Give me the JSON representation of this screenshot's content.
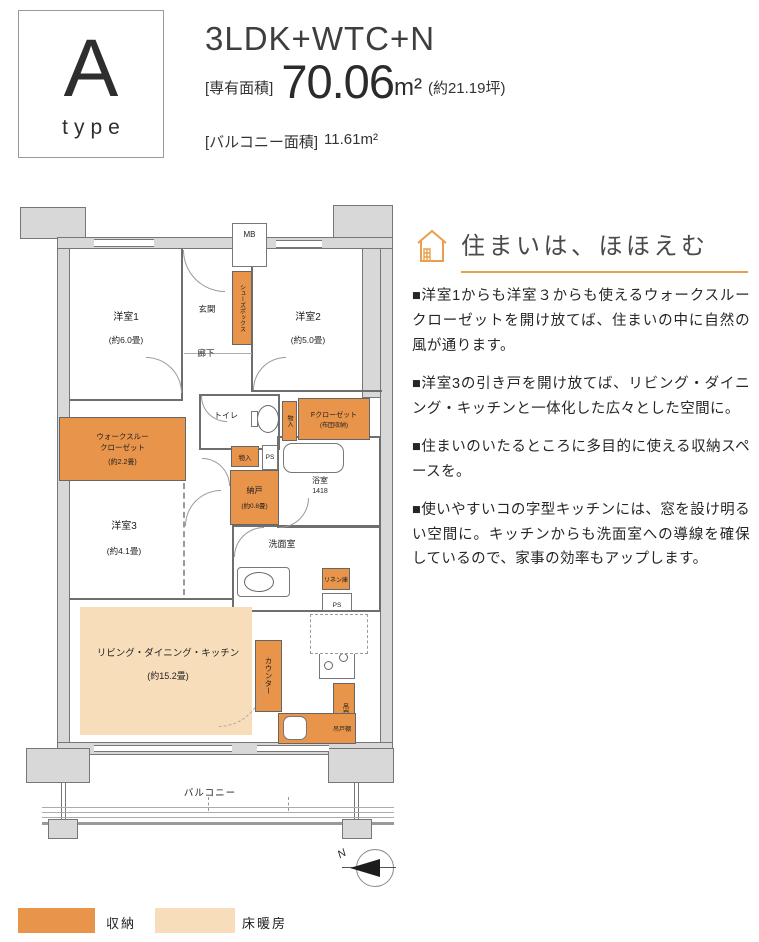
{
  "colors": {
    "accent_orange": "#E8A04E",
    "storage_orange": "#E8954B",
    "floor_heating_peach": "#F8DDBB",
    "wall_gray": "#D8D8D8"
  },
  "header": {
    "type_letter": "A",
    "type_word": "type",
    "plan_name": "3LDK+WTC+N",
    "area_label": "[専有面積]",
    "area_value": "70.06",
    "area_unit": "m²",
    "area_tsubo": "(約21.19坪)",
    "balcony_label": "[バルコニー面積]",
    "balcony_value": "11.61m²"
  },
  "feature": {
    "heading": "住まいは、ほほえむ",
    "paragraphs": [
      "■洋室1からも洋室３からも使えるウォークスルークローゼットを開け放てば、住まいの中に自然の風が通ります。",
      "■洋室3の引き戸を開け放てば、リビング・ダイニング・キッチンと一体化した広々とした空間に。",
      "■住まいのいたるところに多目的に使える収納スペースを。",
      "■使いやすいコの字型キッチンには、窓を設け明るい空間に。キッチンからも洗面室への導線を確保しているので、家事の効率もアップします。"
    ]
  },
  "plan": {
    "mb": "MB",
    "genkan": "玄関",
    "shoes_box": "シューズボックス",
    "rouka": "廊下",
    "room1_name": "洋室1",
    "room1_size": "(約6.0畳)",
    "room2_name": "洋室2",
    "room2_size": "(約5.0畳)",
    "room3_name": "洋室3",
    "room3_size": "(約4.1畳)",
    "toilet": "トイレ",
    "monoire_tall": "物入",
    "f_closet_name": "Fクローゼット",
    "f_closet_sub": "(布団収納)",
    "monoire": "物入",
    "ps_upper": "PS",
    "nando_name": "納戸",
    "nando_size": "(約0.8畳)",
    "bath_name": "浴室",
    "bath_size": "1418",
    "wtc_line1": "ウォークスルー",
    "wtc_line2": "クローゼット",
    "wtc_size": "(約2.2畳)",
    "senmen": "洗面室",
    "linen": "リネン庫",
    "ps_lower": "PS",
    "ldk_name": "リビング・ダイニング・キッチン",
    "ldk_size": "(約15.2畳)",
    "counter": "カウンター",
    "hanging_cabinet_right": "吊戸棚",
    "hanging_cabinet_bottom": "吊戸棚",
    "balcony": "バルコニー",
    "compass_north": "N"
  },
  "legend": {
    "storage_label": "収納",
    "floor_heating_label": "床暖房"
  }
}
